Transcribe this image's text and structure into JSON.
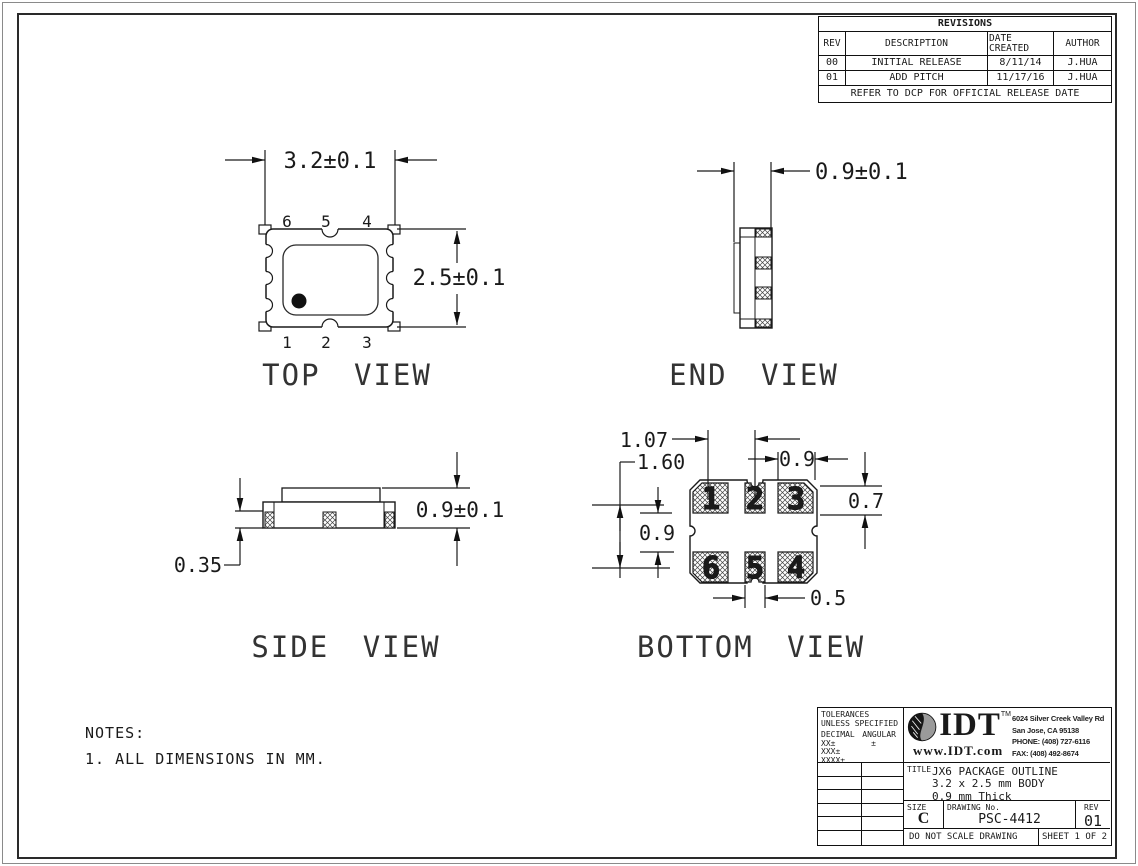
{
  "colors": {
    "line": "#1a1a1a",
    "hatch": "#444444",
    "logo_gray": "#9a9a9a"
  },
  "revisions": {
    "title": "REVISIONS",
    "columns": {
      "rev": "REV",
      "description": "DESCRIPTION",
      "date": "DATE CREATED",
      "author": "AUTHOR"
    },
    "rows": [
      {
        "rev": "00",
        "description": "INITIAL RELEASE",
        "date": "8/11/14",
        "author": "J.HUA"
      },
      {
        "rev": "01",
        "description": "ADD PITCH",
        "date": "11/17/16",
        "author": "J.HUA"
      }
    ],
    "footer": "REFER TO DCP FOR OFFICIAL RELEASE DATE"
  },
  "views": {
    "top": {
      "label": "TOP VIEW",
      "dim_width": "3.2±0.1",
      "dim_height": "2.5±0.1",
      "pins_top": [
        "6",
        "5",
        "4"
      ],
      "pins_bottom": [
        "1",
        "2",
        "3"
      ]
    },
    "end": {
      "label": "END VIEW",
      "dim_thickness": "0.9±0.1"
    },
    "side": {
      "label": "SIDE VIEW",
      "dim_pad_height": "0.35",
      "dim_height": "0.9±0.1"
    },
    "bottom": {
      "label": "BOTTOM VIEW",
      "pads_top": [
        "1",
        "2",
        "3"
      ],
      "pads_bottom": [
        "6",
        "5",
        "4"
      ],
      "dims": {
        "pad_pitch": "1.07",
        "row_pitch": "1.60",
        "pad3_width": "0.9",
        "pad_height": "0.7",
        "row_gap": "0.9",
        "pad5_width": "0.5"
      }
    }
  },
  "notes": {
    "heading": "NOTES:",
    "note1": "1. ALL DIMENSIONS IN MM."
  },
  "title_block": {
    "tolerances": {
      "line1": "TOLERANCES",
      "line2": "UNLESS SPECIFIED",
      "decimal_label": "DECIMAL",
      "angular_label": "ANGULAR",
      "xx": "XX±",
      "angular_pm": "±",
      "xxx": "XXX±",
      "xxxx": "XXXX±"
    },
    "company": {
      "logo_text": "IDT",
      "trademark": "TM",
      "url": "www.IDT.com",
      "address1": "6024 Silver Creek Valley Rd",
      "address2": "San Jose, CA 95138",
      "address3": "PHONE: (408) 727-6116",
      "address4": "FAX: (408) 492-8674"
    },
    "title_label": "TITLE",
    "title_line1": "JX6 PACKAGE OUTLINE",
    "title_line2": "3.2 x 2.5 mm BODY",
    "title_line3": "0.9 mm Thick",
    "size_label": "SIZE",
    "size_value": "C",
    "drawing_label": "DRAWING No.",
    "drawing_number": "PSC-4412",
    "rev_label": "REV",
    "rev_value": "01",
    "scale_note": "DO NOT SCALE DRAWING",
    "sheet_note": "SHEET 1 OF 2"
  }
}
